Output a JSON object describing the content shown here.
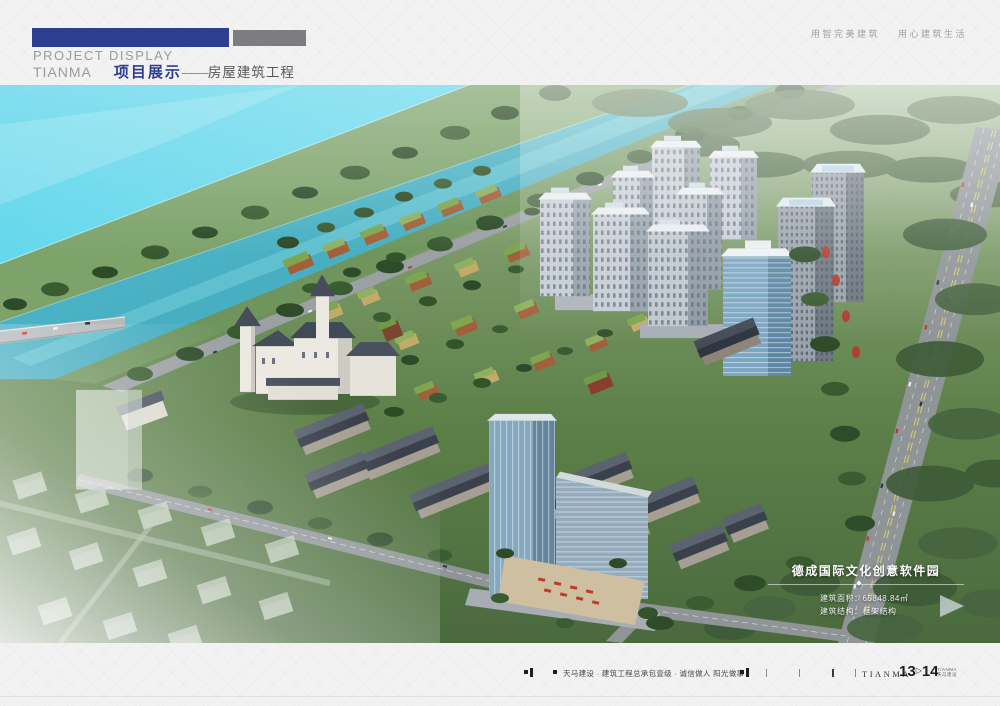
{
  "header": {
    "slogan_part1": "用智完美建筑",
    "slogan_part2": "用心建筑生活",
    "title_en": "PROJECT DISPLAY",
    "brand": "TIANMA",
    "section_cn": "项目展示",
    "dash": "——",
    "section_sub": "房屋建筑工程"
  },
  "project_overlay": {
    "title": "德成国际文化创意软件园",
    "diamond": "◆",
    "line1": "建筑面积：65848.84㎡",
    "line2": "建筑结构：框架结构"
  },
  "footer": {
    "company_line": "天马建设 · 建筑工程总承包壹级 · 诚信做人 阳光做事",
    "brand": "TIANMA",
    "page_current": "13",
    "separator": "▷",
    "page_next": "14",
    "brand_small_line1": "TIANMA",
    "brand_small_line2": "天马建设"
  },
  "colors": {
    "accent_blue": "#2e3d8f",
    "bar_gray": "#7d7d80",
    "page_bg": "#f2f2f3",
    "water_cyan": "#55d4e9",
    "river_teal": "#49b2c4"
  }
}
